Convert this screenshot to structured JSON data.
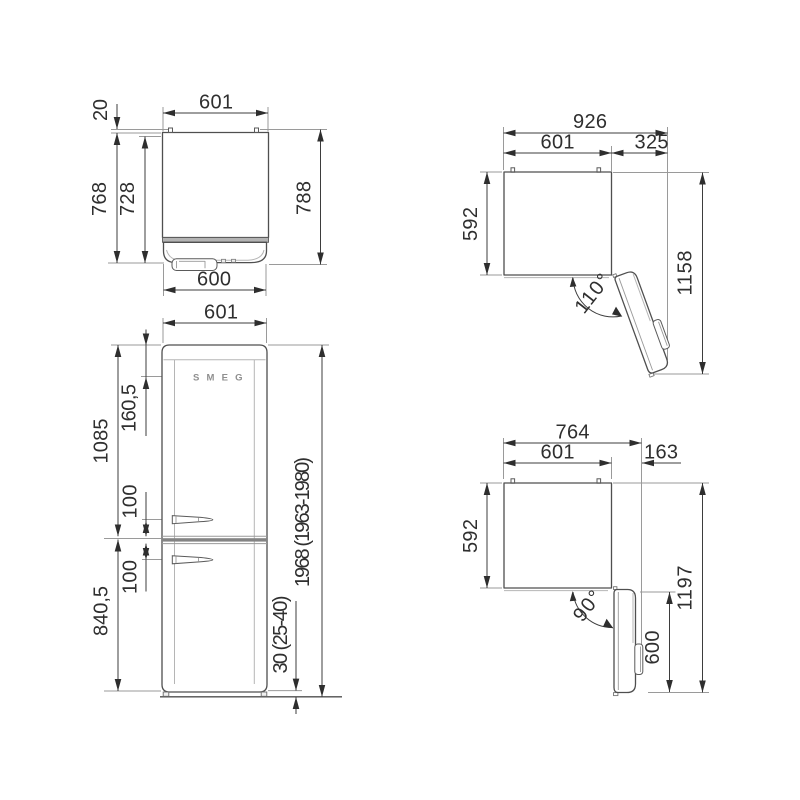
{
  "drawing": {
    "title": "refrigerator dimension drawing",
    "colors": {
      "background": "#ffffff",
      "outline": "#4f4f4f",
      "dimension_line": "#3d3d3d",
      "extension_line": "#9a9a9a",
      "text": "#2f2f2f",
      "divider_shade": "#848484"
    }
  },
  "views": {
    "top_closed": {
      "label": "top view door closed",
      "width": "601",
      "hinge": "20",
      "depth_body": "768",
      "depth_inner": "728",
      "depth_total": "788",
      "door_width": "600"
    },
    "front": {
      "label": "front view",
      "width": "601",
      "logo_offset": "160,5",
      "upper_section": "1085",
      "handle_top": "100",
      "handle_bottom": "100",
      "lower_section": "840,5",
      "total_height": "1968 (1963-1980)",
      "feet": "30 (25-40)",
      "logo": "SMEG"
    },
    "open_110": {
      "label": "top view door open 110°",
      "total_width": "926",
      "body_width": "601",
      "door_swing": "325",
      "depth": "592",
      "total_depth": "1158",
      "angle": "110°"
    },
    "open_90": {
      "label": "top view door open 90°",
      "total_width": "764",
      "body_width": "601",
      "door_swing": "163",
      "depth": "592",
      "door_length": "600",
      "total_depth": "1197",
      "angle": "90°"
    }
  }
}
